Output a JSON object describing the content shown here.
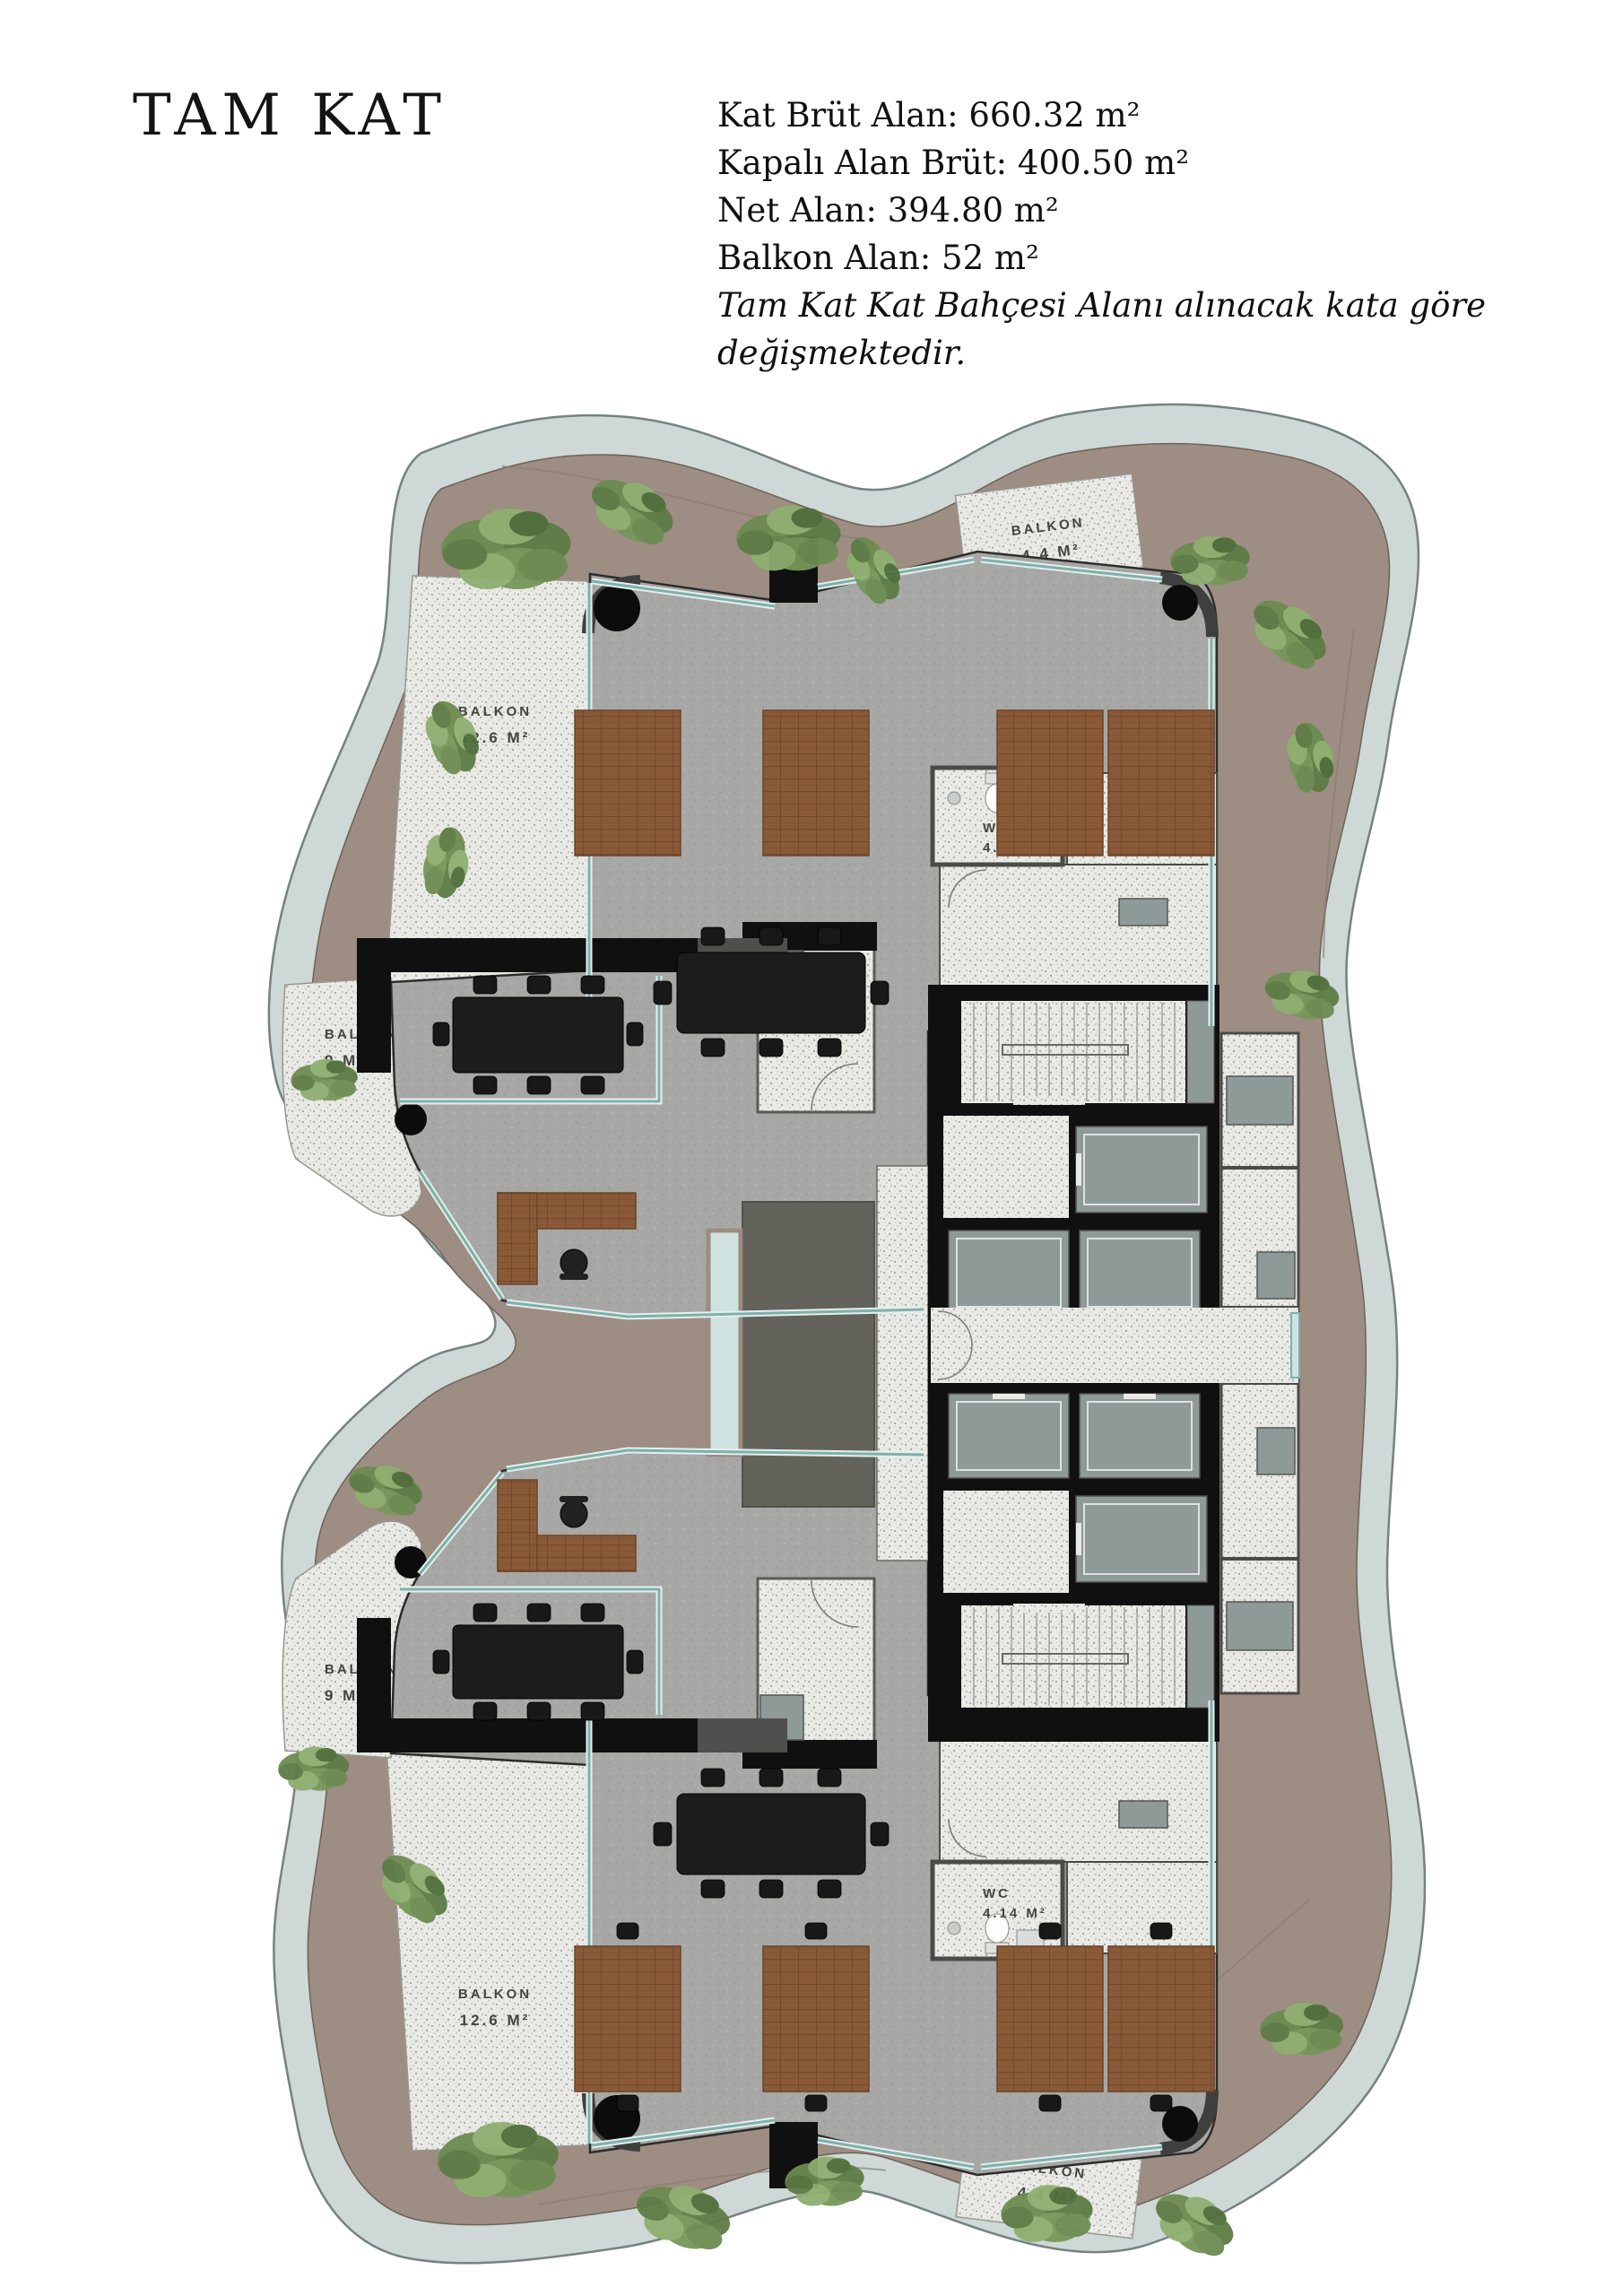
{
  "header": {
    "title": "TAM KAT",
    "stats": [
      "Kat Brüt Alan: 660.32 m²",
      "Kapalı Alan Brüt: 400.50 m²",
      "Net Alan: 394.80 m²",
      "Balkon Alan: 52 m²"
    ],
    "note": "Tam Kat Kat Bahçesi Alanı alınacak kata göre değişmektedir."
  },
  "plan": {
    "labels": {
      "balkon_126_top": {
        "l1": "BALKON",
        "l2": "12.6 M²"
      },
      "balkon_126_bottom": {
        "l1": "BALKON",
        "l2": "12.6 M²"
      },
      "balkon_9_top": {
        "l1": "BALKON",
        "l2": "9 M²"
      },
      "balkon_9_bottom": {
        "l1": "BALKON",
        "l2": "9 M²"
      },
      "balkon_44_top": {
        "l1": "BALKON",
        "l2": "4.4 M²"
      },
      "balkon_44_bottom": {
        "l1": "BALKON",
        "l2": "4.4 M²"
      },
      "wc_top": {
        "l1": "WC",
        "l2": "4.14 M²"
      },
      "wc_bottom": {
        "l1": "WC",
        "l2": "4.14 M²"
      }
    },
    "colors": {
      "band": "#cdd8d7",
      "band_edge": "#75827f",
      "terrace": "#9d8d82",
      "concrete": "#a7a7a5",
      "terrazzo": "#e9e9e5",
      "wall": "#101010",
      "elevator_cab": "#8e9a98",
      "wood": "#8a5a38",
      "glass": "#7fb0aa",
      "void": "#63635c",
      "plant_dark": "#4e6f3a",
      "plant_mid": "#6d8c52",
      "plant_light": "#8fae70"
    }
  }
}
